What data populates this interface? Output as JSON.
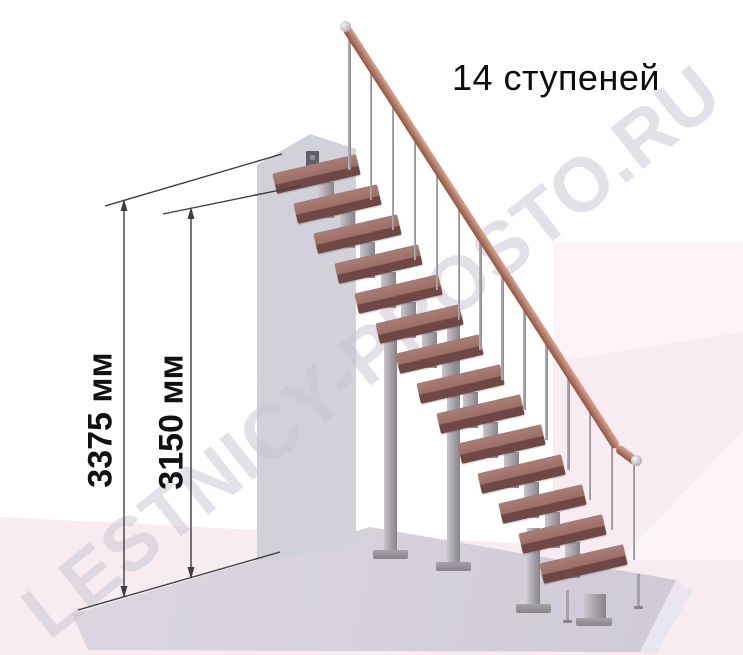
{
  "title": "14 ступеней",
  "watermark": "LESTNICY-PROSTO.RU",
  "dimension_labels": {
    "outer": "3375 мм",
    "inner": "3150 мм"
  },
  "stairs": {
    "step_count": 14,
    "colors": {
      "tread_top": "#9c6e66",
      "tread_top_light": "#a97d74",
      "tread_front": "#6f4744",
      "rail_light": "#d8a892",
      "rail_mid": "#b97f6d",
      "rail_dark": "#8a5544",
      "metal_light": "#c9c5cb",
      "metal_mid": "#a5a1a7",
      "metal_dark": "#87838a"
    }
  },
  "scene_colors": {
    "background": "#ffffff",
    "pink_panel": "#f8ebf1",
    "pink_light": "#fdf3f8",
    "floor_slab": "#d9d4df",
    "wall": "#c8c9d2",
    "dimension_line": "#3f3c42",
    "watermark_color": "rgba(200,196,207,0.5)",
    "text": "#111111"
  }
}
